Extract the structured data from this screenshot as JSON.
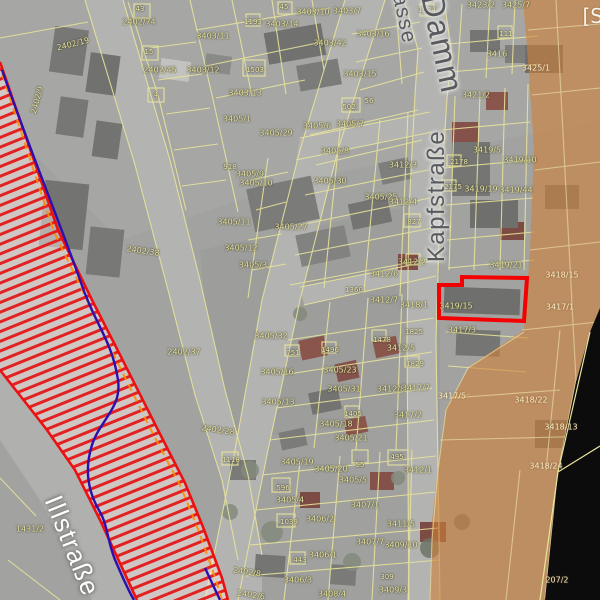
{
  "map": {
    "corner_label": "[S",
    "colors": {
      "highlight_red": "#f40000",
      "hazard_border_red": "#ee1010",
      "hazard_hatch_red": "#e41515",
      "river_line_blue": "#2b0faf",
      "flood_line_orange": "#ff8c00",
      "overlay_orange": "#d0813a",
      "parcel_line_yellow": "#e9e59b",
      "no_data_black": "#0c0c0c"
    },
    "street_labels": [
      {
        "text": "Illstraße",
        "x": 72,
        "y": 546,
        "rot": 68,
        "size": 26,
        "variant": "light"
      },
      {
        "text": "Kapfstraße",
        "x": 437,
        "y": 196,
        "rot": -90,
        "size": 24,
        "variant": "dark"
      },
      {
        "text": "Damm",
        "x": 442,
        "y": 44,
        "rot": 78,
        "size": 32,
        "variant": "dark"
      },
      {
        "text": "asse",
        "x": 404,
        "y": 19,
        "rot": 78,
        "size": 21,
        "variant": "dark"
      }
    ],
    "highlighted_parcel": {
      "label": "3419/15"
    },
    "parcel_labels": [
      {
        "text": "2402/19",
        "x": 73,
        "y": 44,
        "rot": -14
      },
      {
        "text": "2402/74",
        "x": 139,
        "y": 22
      },
      {
        "text": "2402/9",
        "x": 37,
        "y": 100,
        "rot": -75
      },
      {
        "text": "2402/45",
        "x": 160,
        "y": 70
      },
      {
        "text": "3403/12",
        "x": 203,
        "y": 70
      },
      {
        "text": "3403/11",
        "x": 213,
        "y": 36
      },
      {
        "text": "3403/14",
        "x": 282,
        "y": 24
      },
      {
        "text": "3403/10",
        "x": 313,
        "y": 12
      },
      {
        "text": "3403/7",
        "x": 347,
        "y": 11
      },
      {
        "text": "3403/42",
        "x": 330,
        "y": 43
      },
      {
        "text": "3403/16",
        "x": 373,
        "y": 34
      },
      {
        "text": "3403/13",
        "x": 245,
        "y": 93
      },
      {
        "text": "3403/15",
        "x": 360,
        "y": 74
      },
      {
        "text": "3405/1",
        "x": 237,
        "y": 119
      },
      {
        "text": "3405/29",
        "x": 276,
        "y": 133
      },
      {
        "text": "3405/6",
        "x": 317,
        "y": 126
      },
      {
        "text": "3405/7",
        "x": 350,
        "y": 124
      },
      {
        "text": "3405/8",
        "x": 335,
        "y": 151
      },
      {
        "text": "3405/9",
        "x": 250,
        "y": 174
      },
      {
        "text": "3405/10",
        "x": 256,
        "y": 183
      },
      {
        "text": "3405/30",
        "x": 330,
        "y": 181
      },
      {
        "text": "3405/11",
        "x": 234,
        "y": 222
      },
      {
        "text": "3405/27",
        "x": 291,
        "y": 227
      },
      {
        "text": "3405/12",
        "x": 241,
        "y": 248
      },
      {
        "text": "3405/3",
        "x": 253,
        "y": 265
      },
      {
        "text": "3405/25",
        "x": 381,
        "y": 197
      },
      {
        "text": "2402/38",
        "x": 143,
        "y": 251,
        "rot": 8
      },
      {
        "text": "2402/37",
        "x": 184,
        "y": 352
      },
      {
        "text": "2402/28",
        "x": 218,
        "y": 430,
        "rot": 8
      },
      {
        "text": "3405/32",
        "x": 271,
        "y": 336
      },
      {
        "text": "3405/16",
        "x": 277,
        "y": 372
      },
      {
        "text": "3405/13",
        "x": 278,
        "y": 402
      },
      {
        "text": "3405/23",
        "x": 340,
        "y": 370
      },
      {
        "text": "3405/31",
        "x": 344,
        "y": 389
      },
      {
        "text": "3405/18",
        "x": 336,
        "y": 424
      },
      {
        "text": "3405/21",
        "x": 351,
        "y": 438
      },
      {
        "text": "3405/19",
        "x": 297,
        "y": 462
      },
      {
        "text": "3405/20",
        "x": 331,
        "y": 469
      },
      {
        "text": "3405/5",
        "x": 353,
        "y": 480
      },
      {
        "text": "3405/4",
        "x": 290,
        "y": 500
      },
      {
        "text": "3407/1",
        "x": 365,
        "y": 505
      },
      {
        "text": "3406/2",
        "x": 320,
        "y": 519
      },
      {
        "text": "3411/5",
        "x": 401,
        "y": 524
      },
      {
        "text": "3407/7",
        "x": 370,
        "y": 542
      },
      {
        "text": "3409/10",
        "x": 401,
        "y": 545
      },
      {
        "text": "3406/1",
        "x": 323,
        "y": 555
      },
      {
        "text": "2402/8",
        "x": 247,
        "y": 572,
        "rot": 8
      },
      {
        "text": "3406/3",
        "x": 298,
        "y": 580
      },
      {
        "text": "3408/4",
        "x": 332,
        "y": 594
      },
      {
        "text": "2402/6",
        "x": 251,
        "y": 595,
        "rot": 8
      },
      {
        "text": "3409/3",
        "x": 393,
        "y": 590
      },
      {
        "text": "3412/1",
        "x": 418,
        "y": 470
      },
      {
        "text": "3412/3",
        "x": 403,
        "y": 165
      },
      {
        "text": "3412/4",
        "x": 403,
        "y": 202
      },
      {
        "text": "3412/5",
        "x": 401,
        "y": 348
      },
      {
        "text": "3412/6",
        "x": 384,
        "y": 274
      },
      {
        "text": "3412/7",
        "x": 384,
        "y": 300
      },
      {
        "text": "3412/2",
        "x": 412,
        "y": 262
      },
      {
        "text": "3418/1",
        "x": 414,
        "y": 305
      },
      {
        "text": "3412/8",
        "x": 391,
        "y": 389
      },
      {
        "text": "3417/7",
        "x": 416,
        "y": 388
      },
      {
        "text": "3417/2",
        "x": 408,
        "y": 415
      },
      {
        "text": "3417/3",
        "x": 462,
        "y": 330
      },
      {
        "text": "3419/15",
        "x": 456,
        "y": 306
      },
      {
        "text": "3419/21",
        "x": 506,
        "y": 265
      },
      {
        "text": "3419/5",
        "x": 487,
        "y": 150
      },
      {
        "text": "3419/19",
        "x": 481,
        "y": 189
      },
      {
        "text": "3419/44",
        "x": 516,
        "y": 190
      },
      {
        "text": "3419/10",
        "x": 520,
        "y": 160
      },
      {
        "text": "3416",
        "x": 497,
        "y": 54
      },
      {
        "text": "3421/2",
        "x": 476,
        "y": 95
      },
      {
        "text": "3423/2",
        "x": 481,
        "y": 5
      },
      {
        "text": "3425/7",
        "x": 516,
        "y": 5
      },
      {
        "text": "1431/2",
        "x": 30,
        "y": 529
      },
      {
        "text": "3425/1",
        "x": 536,
        "y": 68,
        "on_orange": true
      },
      {
        "text": "3418/15",
        "x": 562,
        "y": 275,
        "on_orange": true
      },
      {
        "text": "3417/1",
        "x": 560,
        "y": 307,
        "on_orange": true
      },
      {
        "text": "3418/22",
        "x": 531,
        "y": 400,
        "on_orange": true
      },
      {
        "text": "3418/13",
        "x": 561,
        "y": 427,
        "on_orange": true
      },
      {
        "text": "3418/24",
        "x": 546,
        "y": 466,
        "on_orange": true
      },
      {
        "text": "3417/5",
        "x": 452,
        "y": 396,
        "on_orange": true
      },
      {
        "text": "207/2",
        "x": 557,
        "y": 580,
        "on_orange": true
      }
    ],
    "building_labels": [
      {
        "text": "43",
        "x": 140,
        "y": 9
      },
      {
        "text": "45",
        "x": 284,
        "y": 7
      },
      {
        "text": "15",
        "x": 149,
        "y": 52
      },
      {
        "text": "4",
        "x": 156,
        "y": 95
      },
      {
        "text": "1193",
        "x": 253,
        "y": 22
      },
      {
        "text": "1503",
        "x": 255,
        "y": 70
      },
      {
        "text": "502",
        "x": 349,
        "y": 107
      },
      {
        "text": "56",
        "x": 369,
        "y": 101
      },
      {
        "text": "918",
        "x": 230,
        "y": 167
      },
      {
        "text": "1360",
        "x": 354,
        "y": 290
      },
      {
        "text": "1478",
        "x": 382,
        "y": 340
      },
      {
        "text": "1825",
        "x": 414,
        "y": 332
      },
      {
        "text": "1829",
        "x": 415,
        "y": 364
      },
      {
        "text": "1496",
        "x": 330,
        "y": 350
      },
      {
        "text": "751",
        "x": 293,
        "y": 353
      },
      {
        "text": "1405",
        "x": 353,
        "y": 414
      },
      {
        "text": "2178",
        "x": 459,
        "y": 162
      },
      {
        "text": "2175",
        "x": 453,
        "y": 187
      },
      {
        "text": "827",
        "x": 414,
        "y": 222
      },
      {
        "text": "1124",
        "x": 427,
        "y": 10
      },
      {
        "text": "111",
        "x": 506,
        "y": 34
      },
      {
        "text": "1118",
        "x": 231,
        "y": 460
      },
      {
        "text": "596",
        "x": 283,
        "y": 488
      },
      {
        "text": "1039",
        "x": 289,
        "y": 522
      },
      {
        "text": "443",
        "x": 300,
        "y": 560
      },
      {
        "text": "495",
        "x": 397,
        "y": 457
      },
      {
        "text": "55",
        "x": 360,
        "y": 465
      },
      {
        "text": "309",
        "x": 387,
        "y": 577
      }
    ]
  }
}
